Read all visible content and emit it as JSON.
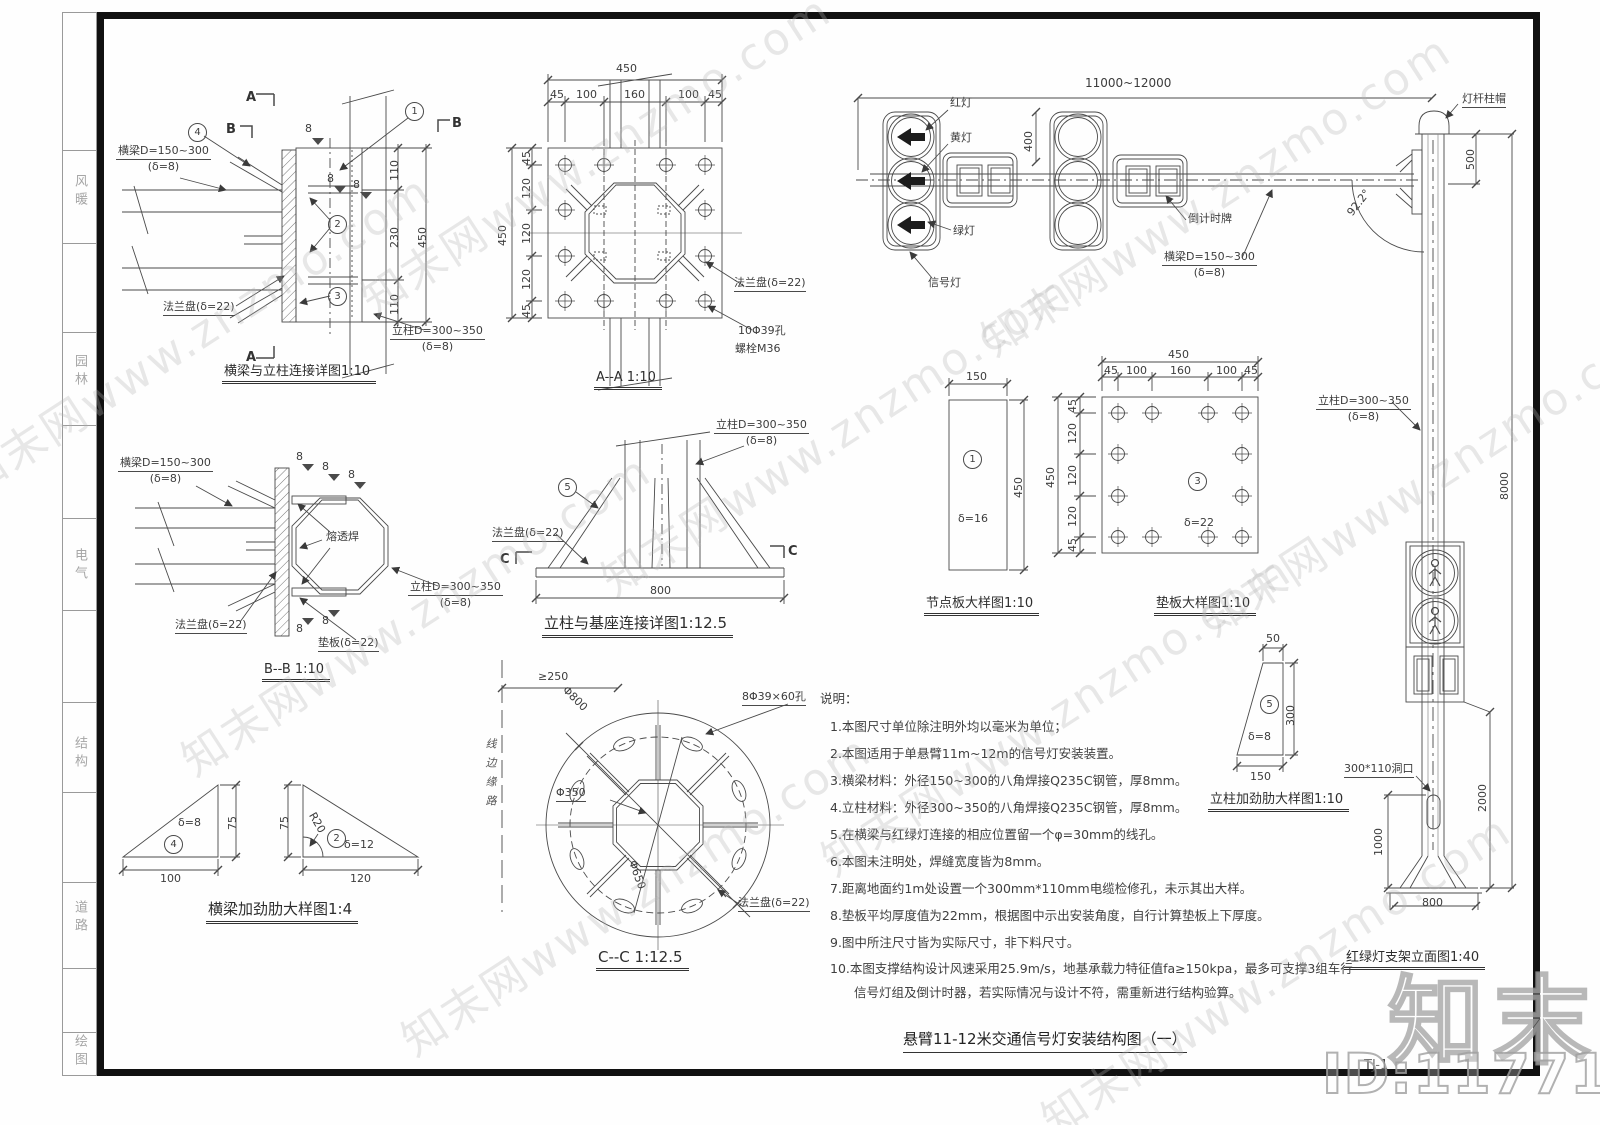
{
  "watermark": {
    "site": "知末网www.znzmo.com",
    "brand": "知末",
    "id": "ID:1177109355"
  },
  "sheet": {
    "title": "悬臂11-12米交通信号灯安装结构图（一）",
    "no": "TJ-1",
    "disciplines": [
      "风暖",
      "园林",
      "电气",
      "结构",
      "道路",
      "绘图"
    ]
  },
  "common": {
    "beam": "横梁D=150~300",
    "beam_t": "(δ=8)",
    "col": "立柱D=300~350",
    "col_t": "(δ=8)",
    "flange": "法兰盘(δ=22)",
    "pad": "垫板(δ=22)",
    "weld": "8"
  },
  "d1": {
    "caption": "横梁与立柱连接详图1:10",
    "dim_a": "110",
    "dim_b": "230",
    "dim_c": "110",
    "dim_total": "450",
    "mark_a": "A",
    "mark_b": "B",
    "b1": "1",
    "b2": "2",
    "b3": "3",
    "b4": "4"
  },
  "d2": {
    "caption": "A--A 1:10",
    "total_h": "450",
    "total_v": "450",
    "segs_h": [
      "45",
      "100",
      "160",
      "100",
      "45"
    ],
    "segs_v": [
      "45",
      "120",
      "120",
      "120",
      "45"
    ],
    "hole": "10Φ39孔",
    "bolt": "螺栓M36"
  },
  "d3": {
    "span": "11000~12000",
    "head_h": "400",
    "red": "红灯",
    "yellow": "黄灯",
    "green": "绿灯",
    "signal": "信号灯",
    "countdown": "倒计时牌"
  },
  "d4": {
    "cap": "灯杆柱帽",
    "d500": "500",
    "d8000": "8000",
    "angle": "92.2°",
    "d2000": "2000",
    "d1000": "1000",
    "hole": "300*110洞口",
    "d800": "800",
    "caption": "红绿灯支架立面图1:40"
  },
  "d5": {
    "caption": "B--B 1:10",
    "weld_label": "熔透焊"
  },
  "d6": {
    "caption": "立柱与基座连接详图1:12.5",
    "d800": "800",
    "mark": "C",
    "b5": "5"
  },
  "d7": {
    "caption": "节点板大样图1:10",
    "w": "150",
    "h": "450",
    "thk": "δ=16",
    "b1": "1"
  },
  "d8": {
    "caption": "垫板大样图1:10",
    "total_h": "450",
    "total_v": "450",
    "segs_h": [
      "45",
      "100",
      "160",
      "100",
      "45"
    ],
    "segs_v": [
      "45",
      "120",
      "120",
      "120",
      "45"
    ],
    "thk": "δ=22",
    "b3": "3"
  },
  "d9": {
    "caption": "C--C 1:12.5",
    "offset": "≥250",
    "dia_outer": "Φ800",
    "dia_mid": "Φ650",
    "dia_inner": "Φ350",
    "holes": "8Φ39×60孔",
    "curb": "线边缘路"
  },
  "d11": {
    "caption": "横梁加劲肋大样图1:4",
    "t1_h": "75",
    "t1_w": "100",
    "t1_thk": "δ=8",
    "t1_b": "4",
    "t2_h": "75",
    "t2_w": "120",
    "t2_r": "R20",
    "t2_thk": "δ=12",
    "t2_b": "2"
  },
  "d12": {
    "caption": "立柱加劲肋大样图1:10",
    "top": "50",
    "side": "300",
    "base": "150",
    "thk": "δ=8",
    "b5": "5"
  },
  "notes": {
    "title": "说明：",
    "items": [
      "1.本图尺寸单位除注明外均以毫米为单位；",
      "2.本图适用于单悬臂11m~12m的信号灯安装装置。",
      "3.横梁材料：外径150~300的八角焊接Q235C钢管，厚8mm。",
      "4.立柱材料：外径300~350的八角焊接Q235C钢管，厚8mm。",
      "5.在横梁与红绿灯连接的相应位置留一个φ=30mm的线孔。",
      "6.本图未注明处，焊缝宽度皆为8mm。",
      "7.距离地面约1m处设置一个300mm*110mm电缆检修孔，未示其出大样。",
      "8.垫板平均厚度值为22mm，根据图中示出安装角度，自行计算垫板上下厚度。",
      "9.图中所注尺寸皆为实际尺寸，非下料尺寸。",
      "10.本图支撑结构设计风速采用25.9m/s，地基承载力特征值fa≥150kpa，最多可支撑3组车行",
      "信号灯组及倒计时器，若实际情况与设计不符，需重新进行结构验算。"
    ]
  }
}
